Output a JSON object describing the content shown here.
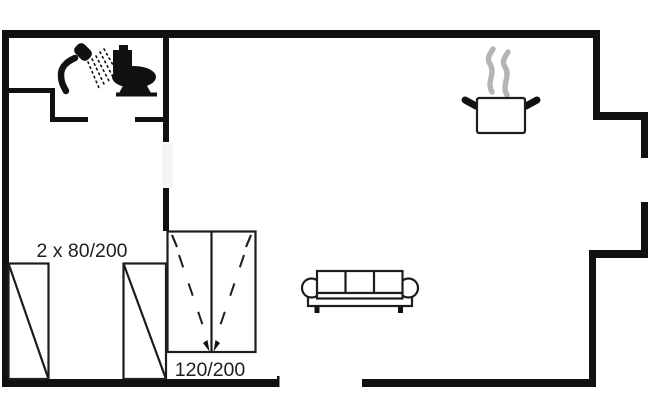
{
  "floorplan": {
    "labels": {
      "beds_dimension": "2 x 80/200",
      "wardrobe_dimension": "120/200"
    },
    "colors": {
      "bg": "#ffffff",
      "wall": "#111111",
      "line": "#1d1d1d",
      "steam": "#b4b4b7",
      "text": "#1f1f1f",
      "doorgap": "#f5f5f5"
    },
    "icons": [
      "shower-icon",
      "toilet-icon",
      "steam-icon",
      "cooking-pot-icon",
      "sofa-icon",
      "single-bed-icon",
      "single-bed-icon",
      "wardrobe-icon"
    ]
  }
}
